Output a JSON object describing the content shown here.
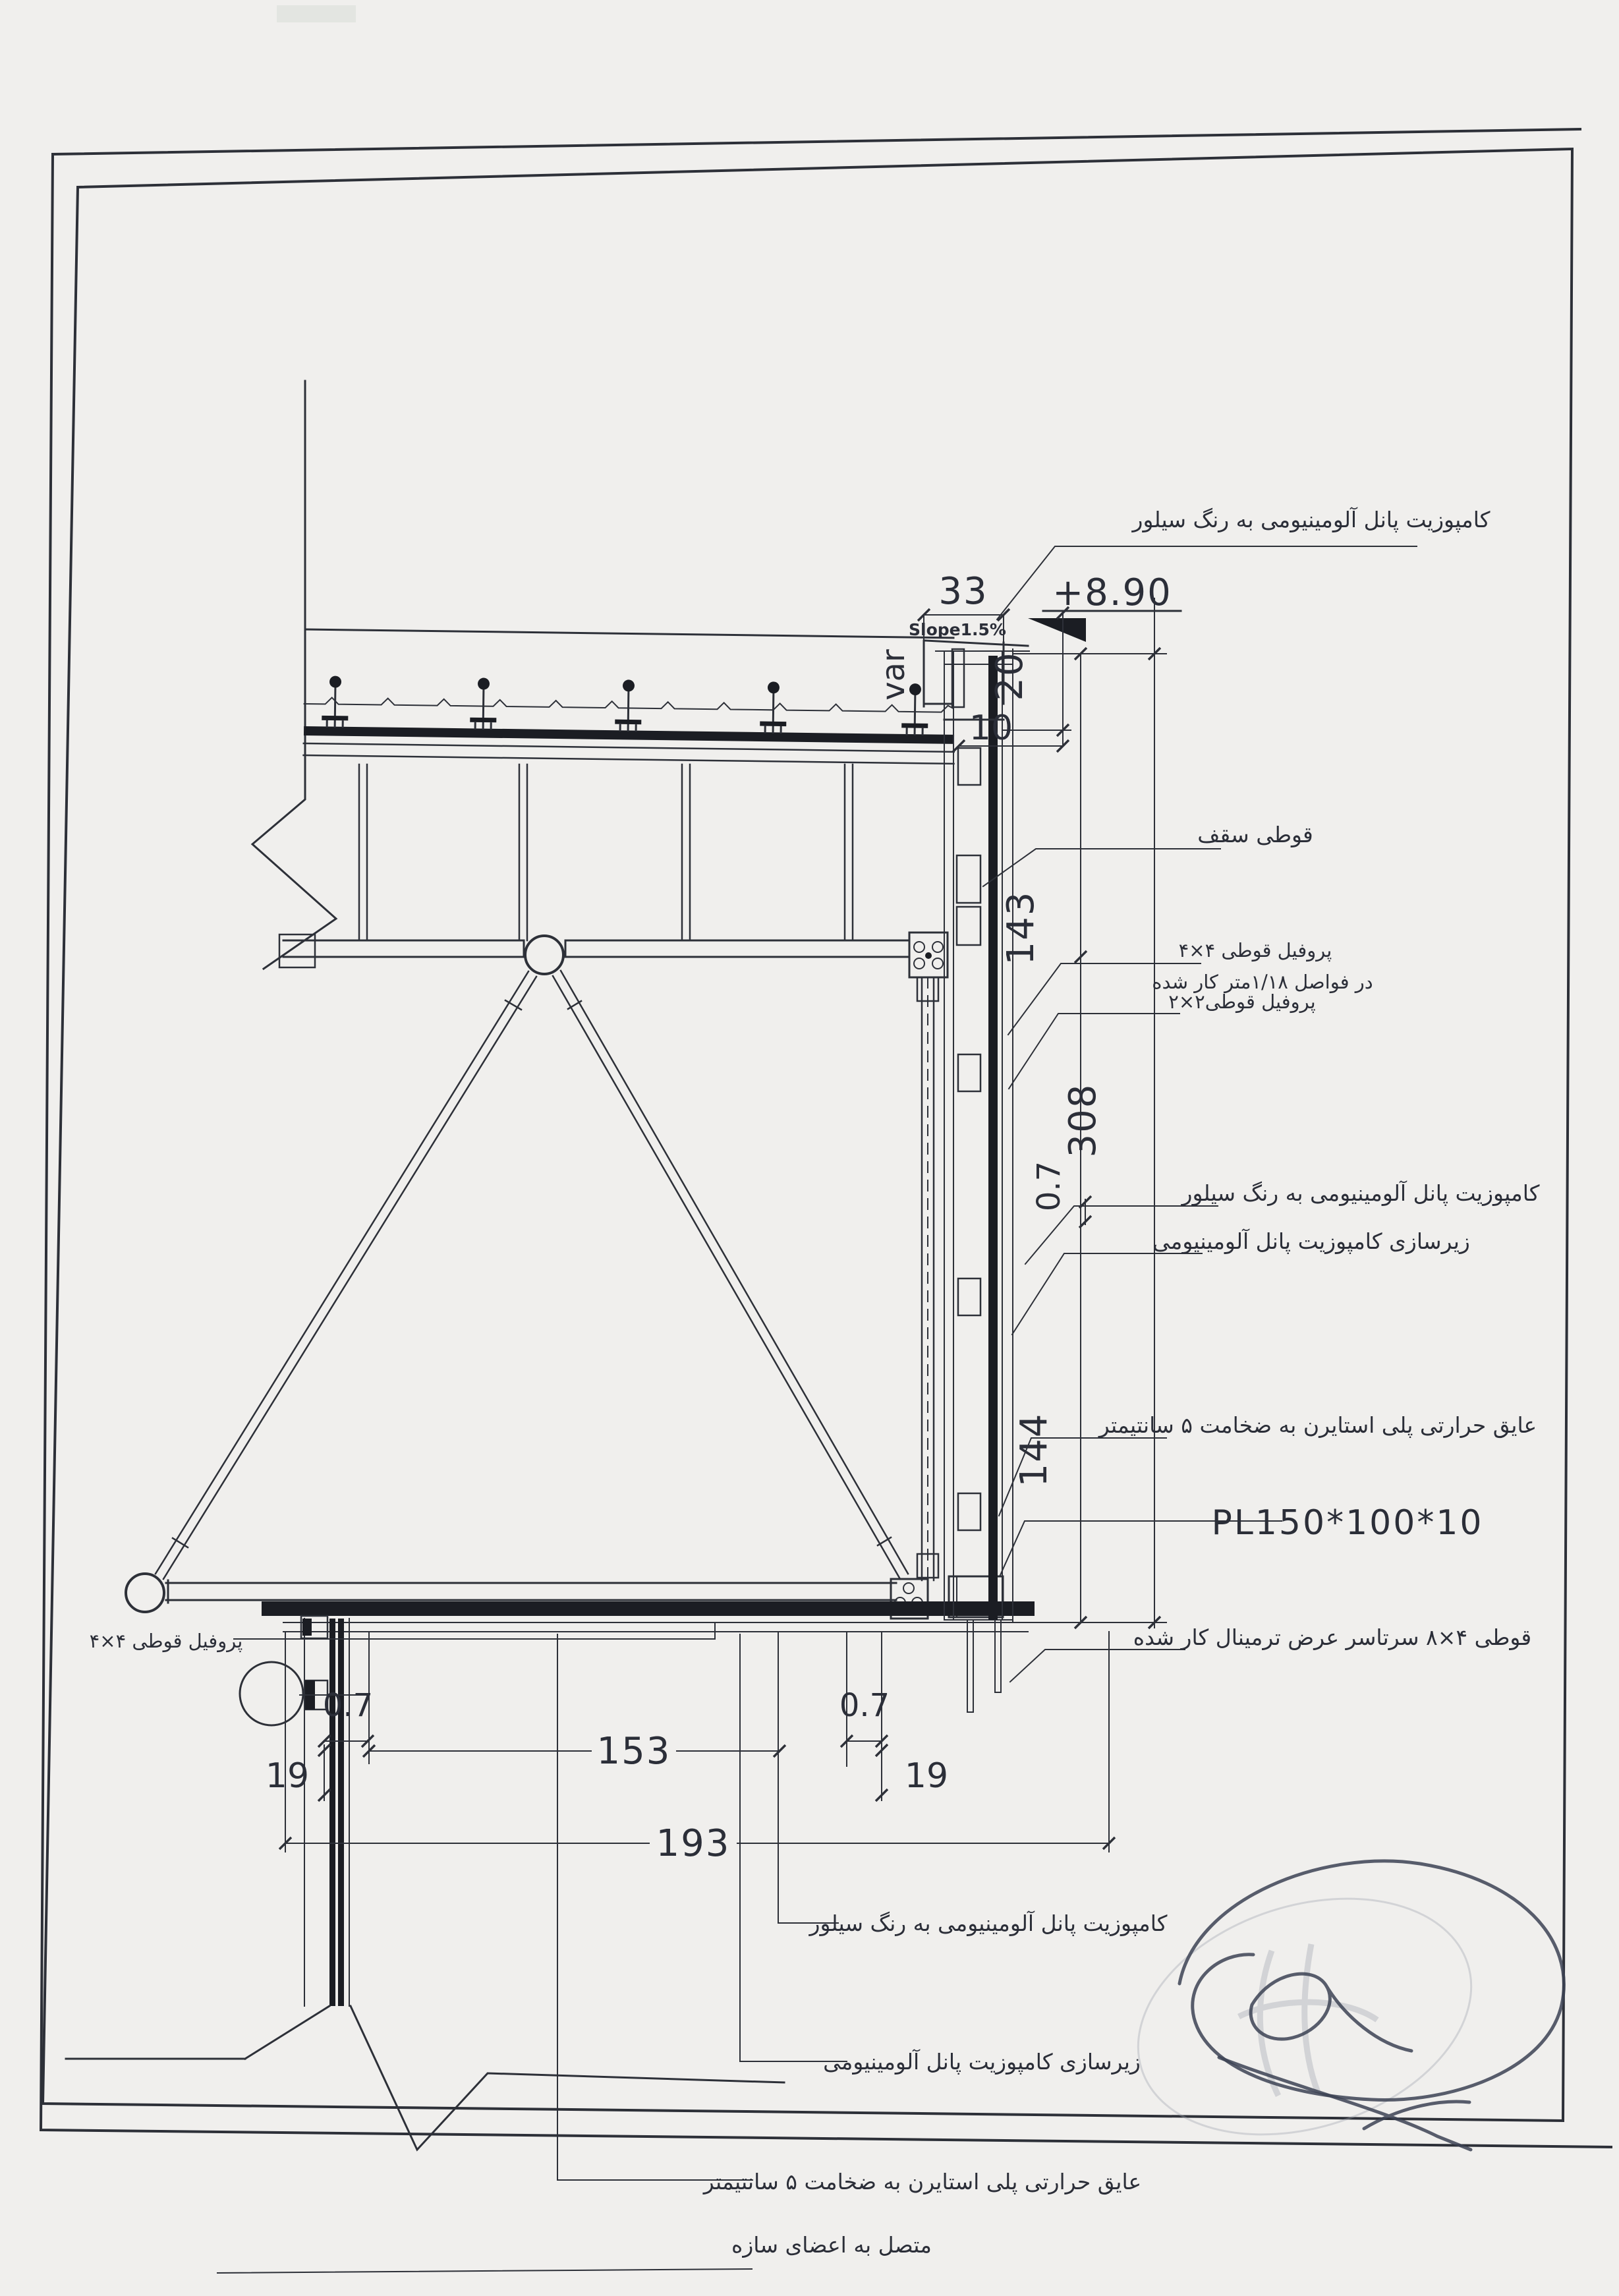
{
  "drawing": {
    "annotations": {
      "level": "+8.90",
      "slope": "Slope1.5%",
      "variable": "var",
      "plate": "PL150*100*10"
    },
    "dimensions": {
      "top_width": "33",
      "parapet_height": "20",
      "cap_width": "10",
      "upper_segment": "143",
      "overall_height": "308",
      "panel_thickness_mid": "0.7",
      "lower_segment": "144",
      "soffit_clear": "153",
      "soffit_overall": "193",
      "panel_thickness_left": "0.7",
      "edge_drop_left": "19",
      "panel_thickness_right": "0.7",
      "edge_drop_right": "19"
    },
    "callouts": {
      "top_panel": "کامپوزیت پانل آلومینیومی به رنگ سیلور",
      "roof_box": "قوطی سقف",
      "profile_4x4_line1": "پروفیل قوطی ۴×۴",
      "profile_4x4_line2": "در فواصل ۱/۱۸متر کار شده",
      "profile_2x2": "پروفیل قوطی۲×۲",
      "mid_panel": "کامپوزیت پانل آلومینیومی به رنگ سیلور",
      "substructure": "زیرسازی کامپوزیت پانل آلومینیومی",
      "insulation": "عایق حرارتی پلی استایرن به ضخامت ۵ سانتیمتر",
      "box_4x8": "قوطی ۴×۸ سرتاسر عرض ترمینال کار شده",
      "bottom_panel": "کامپوزیت پانل آلومینیومی به رنگ سیلور",
      "bottom_substructure": "زیرسازی کامپوزیت پانل آلومینیومی",
      "bottom_insulation_line1": "عایق حرارتی پلی استایرن به ضخامت ۵ سانتیمتر",
      "bottom_insulation_line2": "متصل به اعضای سازه",
      "left_profile_4x4": "پروفیل قوطی ۴×۴"
    }
  }
}
